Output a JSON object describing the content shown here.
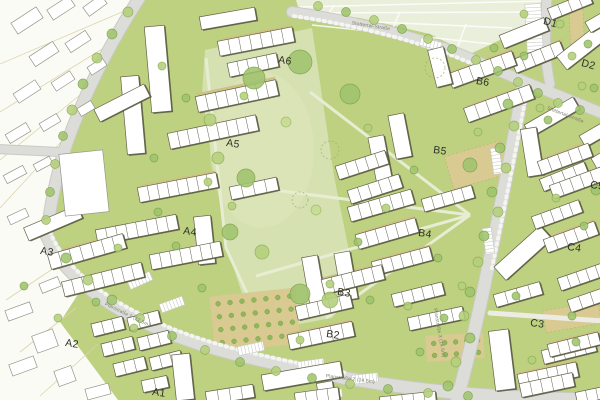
{
  "map_title": "site development plan",
  "blocks": {
    "a1": "A1",
    "a2": "A2",
    "a3": "A3",
    "a4": "A4",
    "a5": "A5",
    "a6": "A6",
    "b2": "B2",
    "b3": "B3",
    "b4": "B4",
    "b5": "B5",
    "b6": "B6",
    "c3": "C3",
    "c4": "C4",
    "c5": "C5",
    "d1": "D1",
    "d2": "D2"
  },
  "streets": {
    "stottertal_top": "Stottertal-Straße",
    "stottertal_right": "Stottertal-Straße",
    "plan1": "Planstraße 1 (12.5m)",
    "plan2": "Planstraße 2 (14.5m)",
    "plan3": "Planstraße 3 (14.5m)"
  },
  "colors": {
    "lawn": "#bdd180",
    "park": "#d6e1b2",
    "field": "#e9efda",
    "existing_area": "#fbfbf5",
    "road": "#dcddd8",
    "road_casing": "#c9cac4",
    "tan_path": "#d8ca90",
    "building_fill": "#ffffff",
    "building_outline": "#63624b",
    "building_shadow": "#54533c",
    "tree_light": "#b5d07c",
    "tree_dark": "#a0c46e",
    "label_text": "#2f2f28",
    "street_text": "#7d7d72"
  }
}
